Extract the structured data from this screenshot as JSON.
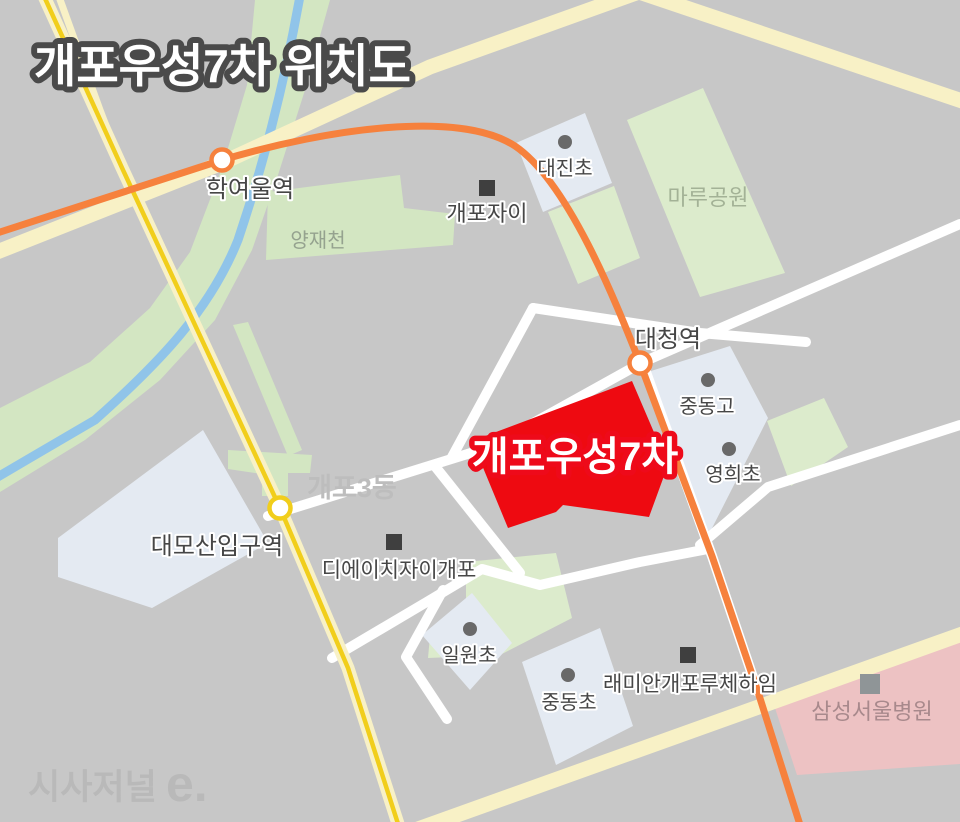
{
  "title": "개포우성7차 위치도",
  "watermark": {
    "brand": "시사저널",
    "suffix": "e."
  },
  "target_complex": {
    "name": "개포우성7차"
  },
  "stations": {
    "hakyeoul": "학여울역",
    "daecheong": "대청역",
    "daemosan_ipgu": "대모산입구역"
  },
  "schools": {
    "daejin": "대진초",
    "jungdong_high": "중동고",
    "yeonghui": "영희초",
    "ilwon": "일원초",
    "jungdong_elem": "중동초"
  },
  "apartments": {
    "gaepo_xi": "개포자이",
    "dh_xi_gaepo": "디에이치자이개포",
    "raemian_lucehaim": "래미안개포루체하임"
  },
  "places": {
    "maru_park": "마루공원",
    "yangjaecheon": "양재천",
    "gaepo3dong": "개포3동",
    "samsung_hospital": "삼성서울병원"
  },
  "palette": {
    "background": "#c7c7c7",
    "road_cream": "#f8f1c6",
    "road_white": "#ffffff",
    "metro_line3_orange": "#f6813d",
    "metro_bundang_yellow": "#f1ce1b",
    "park_green": "#dcebcc",
    "river_band_green": "#d3e6c2",
    "stream_blue": "#90c4e9",
    "school_parcel": "#e4eaf2",
    "target_red": "#ee0a11",
    "hospital_pink": "#edc2c3",
    "marker_dark": "#3f3f3f",
    "marker_dot": "#696969",
    "marker_gray": "#8f9597"
  }
}
